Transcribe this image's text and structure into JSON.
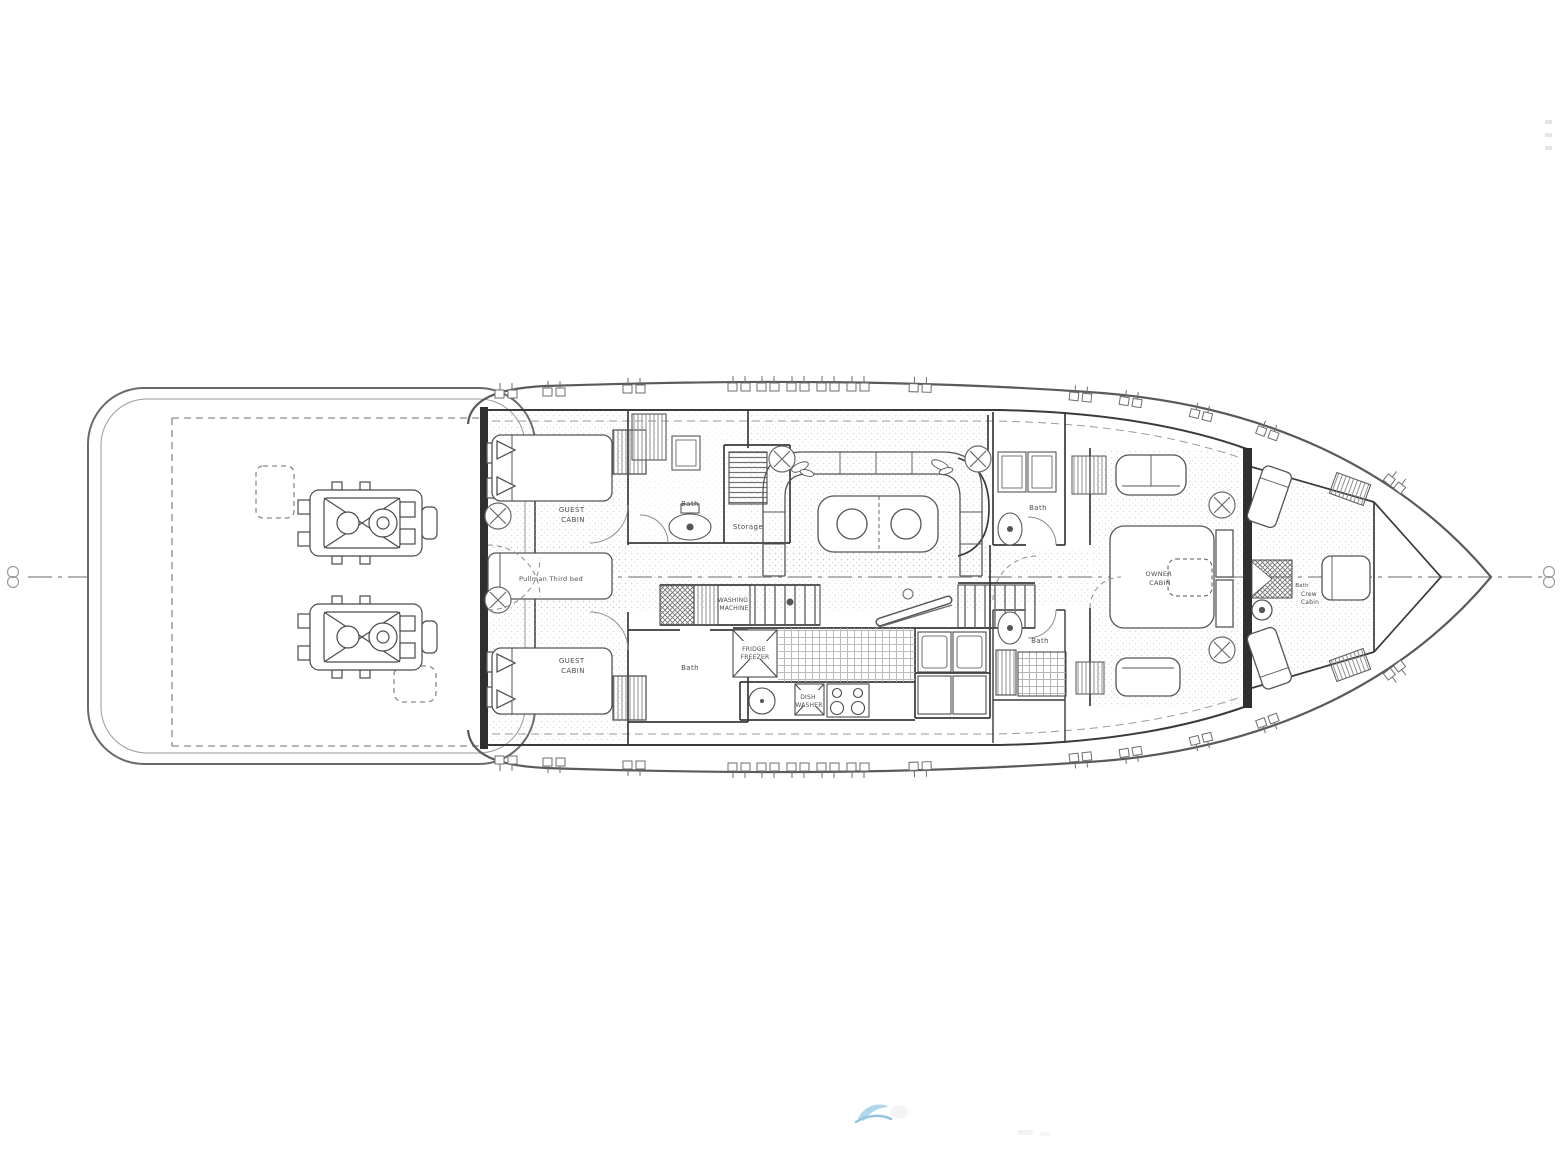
{
  "plan": {
    "type": "yacht-lower-deck-floor-plan",
    "orientation": "bow-right",
    "labels": {
      "guest_cabin_top": [
        "GUEST",
        "CABIN"
      ],
      "guest_cabin_bottom": [
        "GUEST",
        "CABIN"
      ],
      "pullman_bed": [
        "Pullman Third bed"
      ],
      "bath_forward_top": [
        "Bath"
      ],
      "storage": [
        "Storage"
      ],
      "washing_machine": [
        "WASHING",
        "MACHINE"
      ],
      "bath_aft_lower": [
        "Bath"
      ],
      "fridge_freezer": [
        "FRIDGE",
        "FREEZER"
      ],
      "dish_washer": [
        "DISH",
        "WASHER"
      ],
      "bath_mid_upper": [
        "Bath"
      ],
      "bath_mid_lower": [
        "Bath"
      ],
      "owner_cabin": [
        "OWNER",
        "CABIN"
      ],
      "crew_bath": [
        "Bath"
      ],
      "crew_cabin": [
        "Crew",
        "Cabin"
      ]
    },
    "symbols": {
      "deck_hatch": "circle-with-x",
      "centerline_marker": "stacked-circles",
      "porthole": "twin-squares-with-ticks"
    },
    "colors": {
      "background": "#ffffff",
      "wall": "#333333",
      "line": "#4a4a4a",
      "light_line": "#9a9a9a",
      "watermark_blue": "#58aad6"
    }
  }
}
